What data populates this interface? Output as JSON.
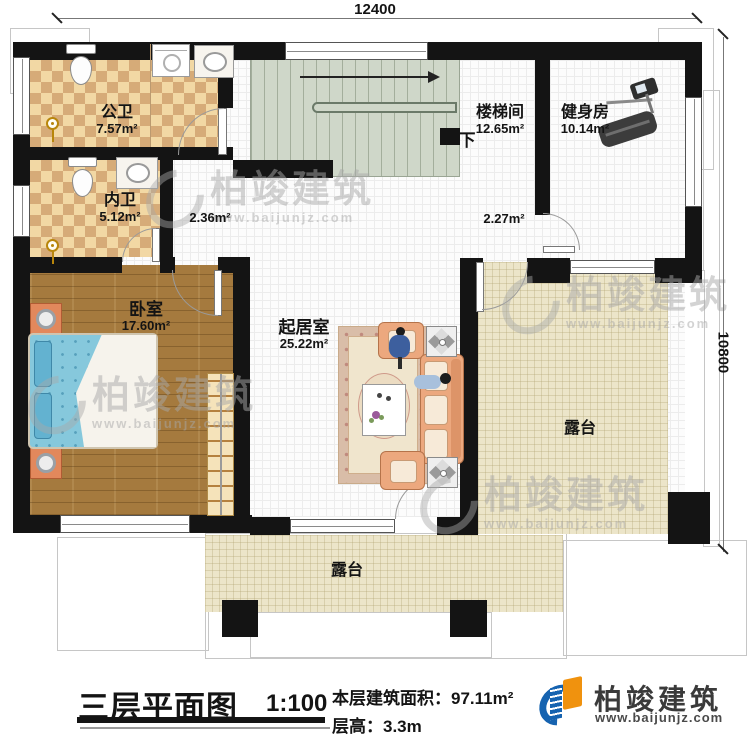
{
  "plan": {
    "dim_top": "12400",
    "dim_right": "10800",
    "rooms": [
      {
        "name": "公卫",
        "area": "7.57m²"
      },
      {
        "name": "内卫",
        "area": "5.12m²"
      },
      {
        "name": "楼梯间",
        "area": "12.65m²"
      },
      {
        "name": "健身房",
        "area": "10.14m²"
      },
      {
        "name": "卧室",
        "area": "17.60m²"
      },
      {
        "name": "起居室",
        "area": "25.22m²"
      },
      {
        "name": "露台"
      },
      {
        "name": "露台"
      }
    ],
    "hall_area_1": "2.36m²",
    "hall_area_2": "2.27m²",
    "stair_down": "下"
  },
  "titleblock": {
    "title": "三层平面图",
    "scale": "1:100",
    "area_label": "本层建筑面积：",
    "area_value": "97.11m²",
    "height_label": "层高：",
    "height_value": "3.3m"
  },
  "brand": {
    "name": "柏竣建筑",
    "website": "www.baijunjz.com"
  },
  "watermark": {
    "name": "柏竣建筑",
    "website": "www.baijunjz.com"
  },
  "colors": {
    "wall": "#141414",
    "logo_blue": "#1663b0",
    "logo_orange": "#f0920e",
    "terrace": "#ece5c9",
    "wood": "#a57a3e",
    "stairs": "#cfd7c9"
  }
}
